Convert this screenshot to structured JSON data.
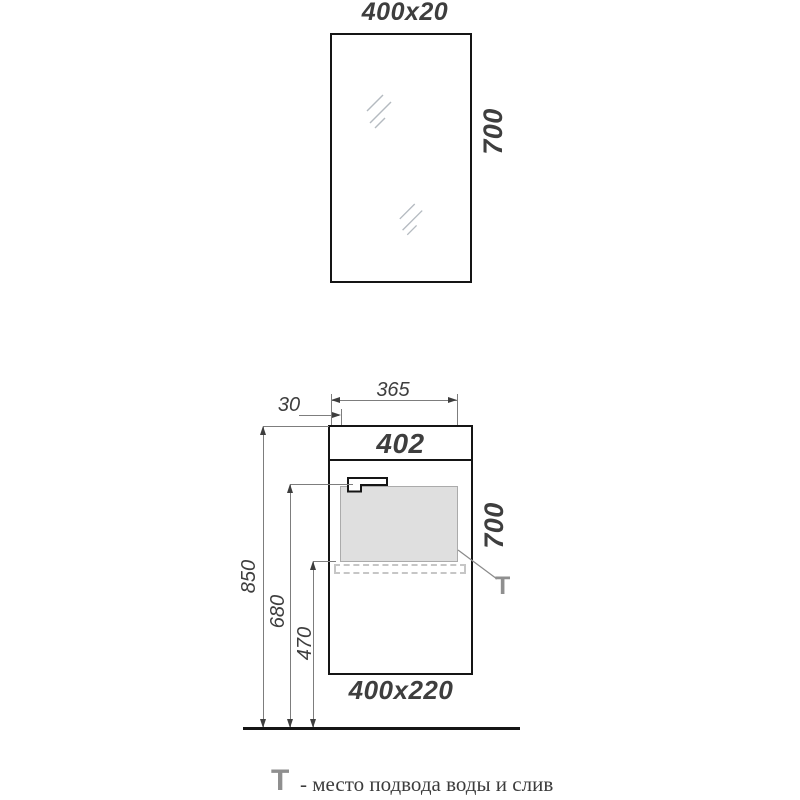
{
  "drawing": {
    "mirror": {
      "size_label": "400x20",
      "height_label": "700"
    },
    "cabinet": {
      "front_label": "402",
      "height_label": "700",
      "size_label": "400x220",
      "dim_side_offset": "30",
      "dim_basin_width": "365",
      "dim_total_height": "850",
      "dim_faucet_height": "680",
      "dim_drain_height": "470",
      "t_marker": "T"
    },
    "legend": {
      "symbol": "T",
      "text": "- место подвода воды и слив"
    },
    "colors": {
      "outline": "#151515",
      "dimension_line": "#7d7d7d",
      "label_text": "#3e3e3e",
      "marker_gray": "#8f8f8f",
      "basin_fill": "#dfdfdf"
    }
  }
}
